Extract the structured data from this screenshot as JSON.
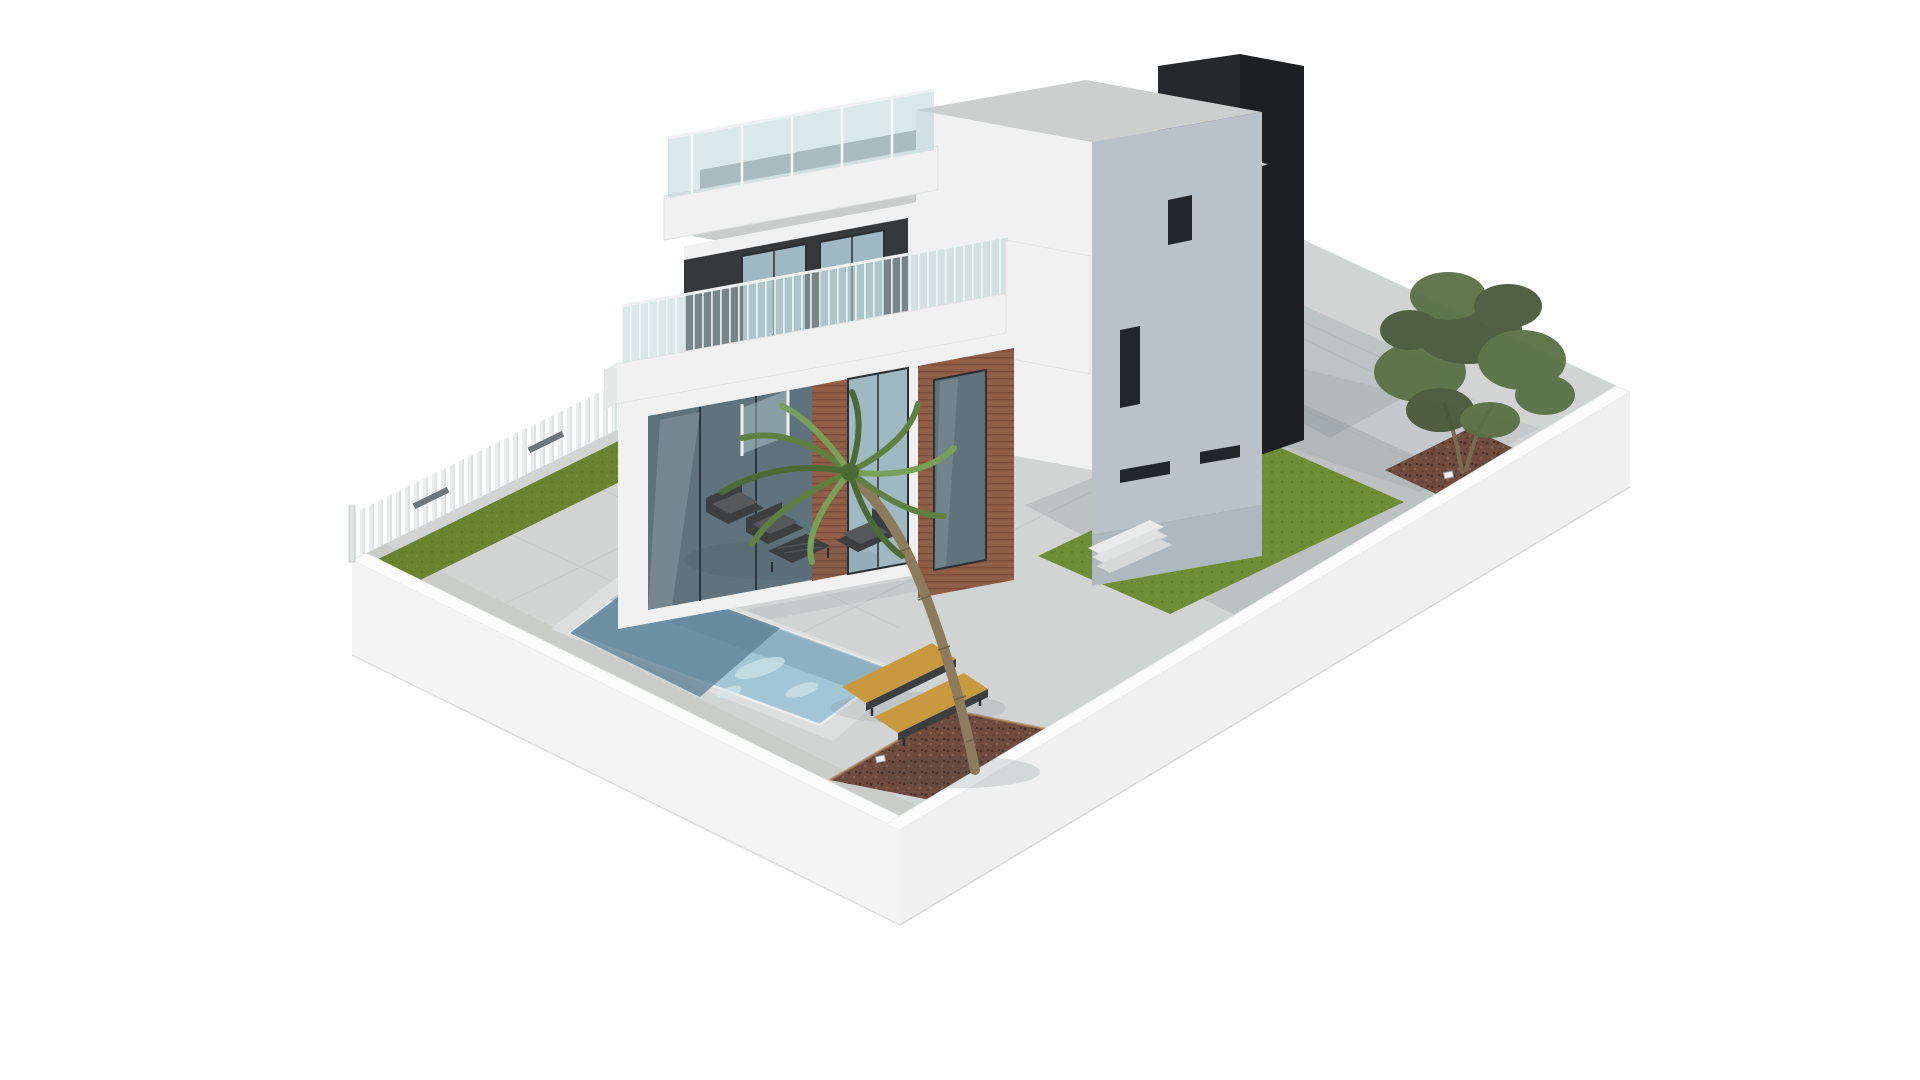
{
  "scene": {
    "kind": "architectural-3d-render",
    "description": "Aerial isometric 3D rendering of a modern three-level white villa with rooftop terrace, glass balustrades, dark charcoal accent volume and chimney, brick-framed ground-floor glazing, private swimming pool, paved patio, lawns, red mulch planting beds with palm tree and olive tree, all enclosed by a white perimeter wall and white slat fence on a plain white background",
    "background": "#ffffff"
  },
  "colors": {
    "bg": "#ffffff",
    "paving": "#d0d5d4",
    "pavingBack": "#b9c1c3",
    "poolDeck": "#dcdfdd",
    "gravel": "#c9ccc8",
    "lawn": "#69832f",
    "lawnRight": "#6f8d35",
    "mulch": "#6f4c3e",
    "wallWhite": "#f3f4f3",
    "wallShade": "#eff0ef",
    "wallInner": "#e2e5e4",
    "wallCap": "#fbfcfb",
    "houseWhite": "#f0f1f0",
    "houseSide": "#b9c2c8",
    "houseSideLow": "#aeb8bf",
    "roofSlab": "#cbd0ce",
    "terraceFloor": "#c8cdcb",
    "terraceBackWall": "#9aa4ab",
    "darkCladding": "#35393c",
    "chimneyDark": "#26292c",
    "chimneySide": "#1d2023",
    "glass": "#b7d2d4",
    "windowGlass": "#9fb9c2",
    "doorGlass": "#5f737c",
    "brick": "#8f5c46",
    "furnitureDark": "#3b3f42",
    "cushion": "#55595c",
    "loungerWood": "#c9993f",
    "trunk": "#8d7b5e",
    "palmGreen": "#5e8040",
    "palmGreenDark": "#4c6a34",
    "palmGreenLight": "#79a058",
    "oliveGreen": "#5a7045",
    "oliveDark": "#49593a",
    "shadow": "#37474f",
    "spotlight": "#f4f4f2",
    "poolWater": "#a3c6d6",
    "poolMid": "#7497ab",
    "poolDark": "#5e8096",
    "poolRipple": "#d3e9ec",
    "windowSlit": "#20262a",
    "steelConnector": "#6f767a"
  },
  "objects": {
    "plot": "walled rectangular garden plot",
    "villa": "modern three-level villa",
    "pool": "rectangular swimming pool",
    "palm": "palm tree in mulch bed",
    "olive": "olive tree in corner mulch bed",
    "fence": "white vertical slat fence",
    "loungers": "two wooden sun loungers",
    "loungeSet": "dark grey outdoor lounge set with coffee table",
    "spotlights": "recessed ground spotlights"
  }
}
